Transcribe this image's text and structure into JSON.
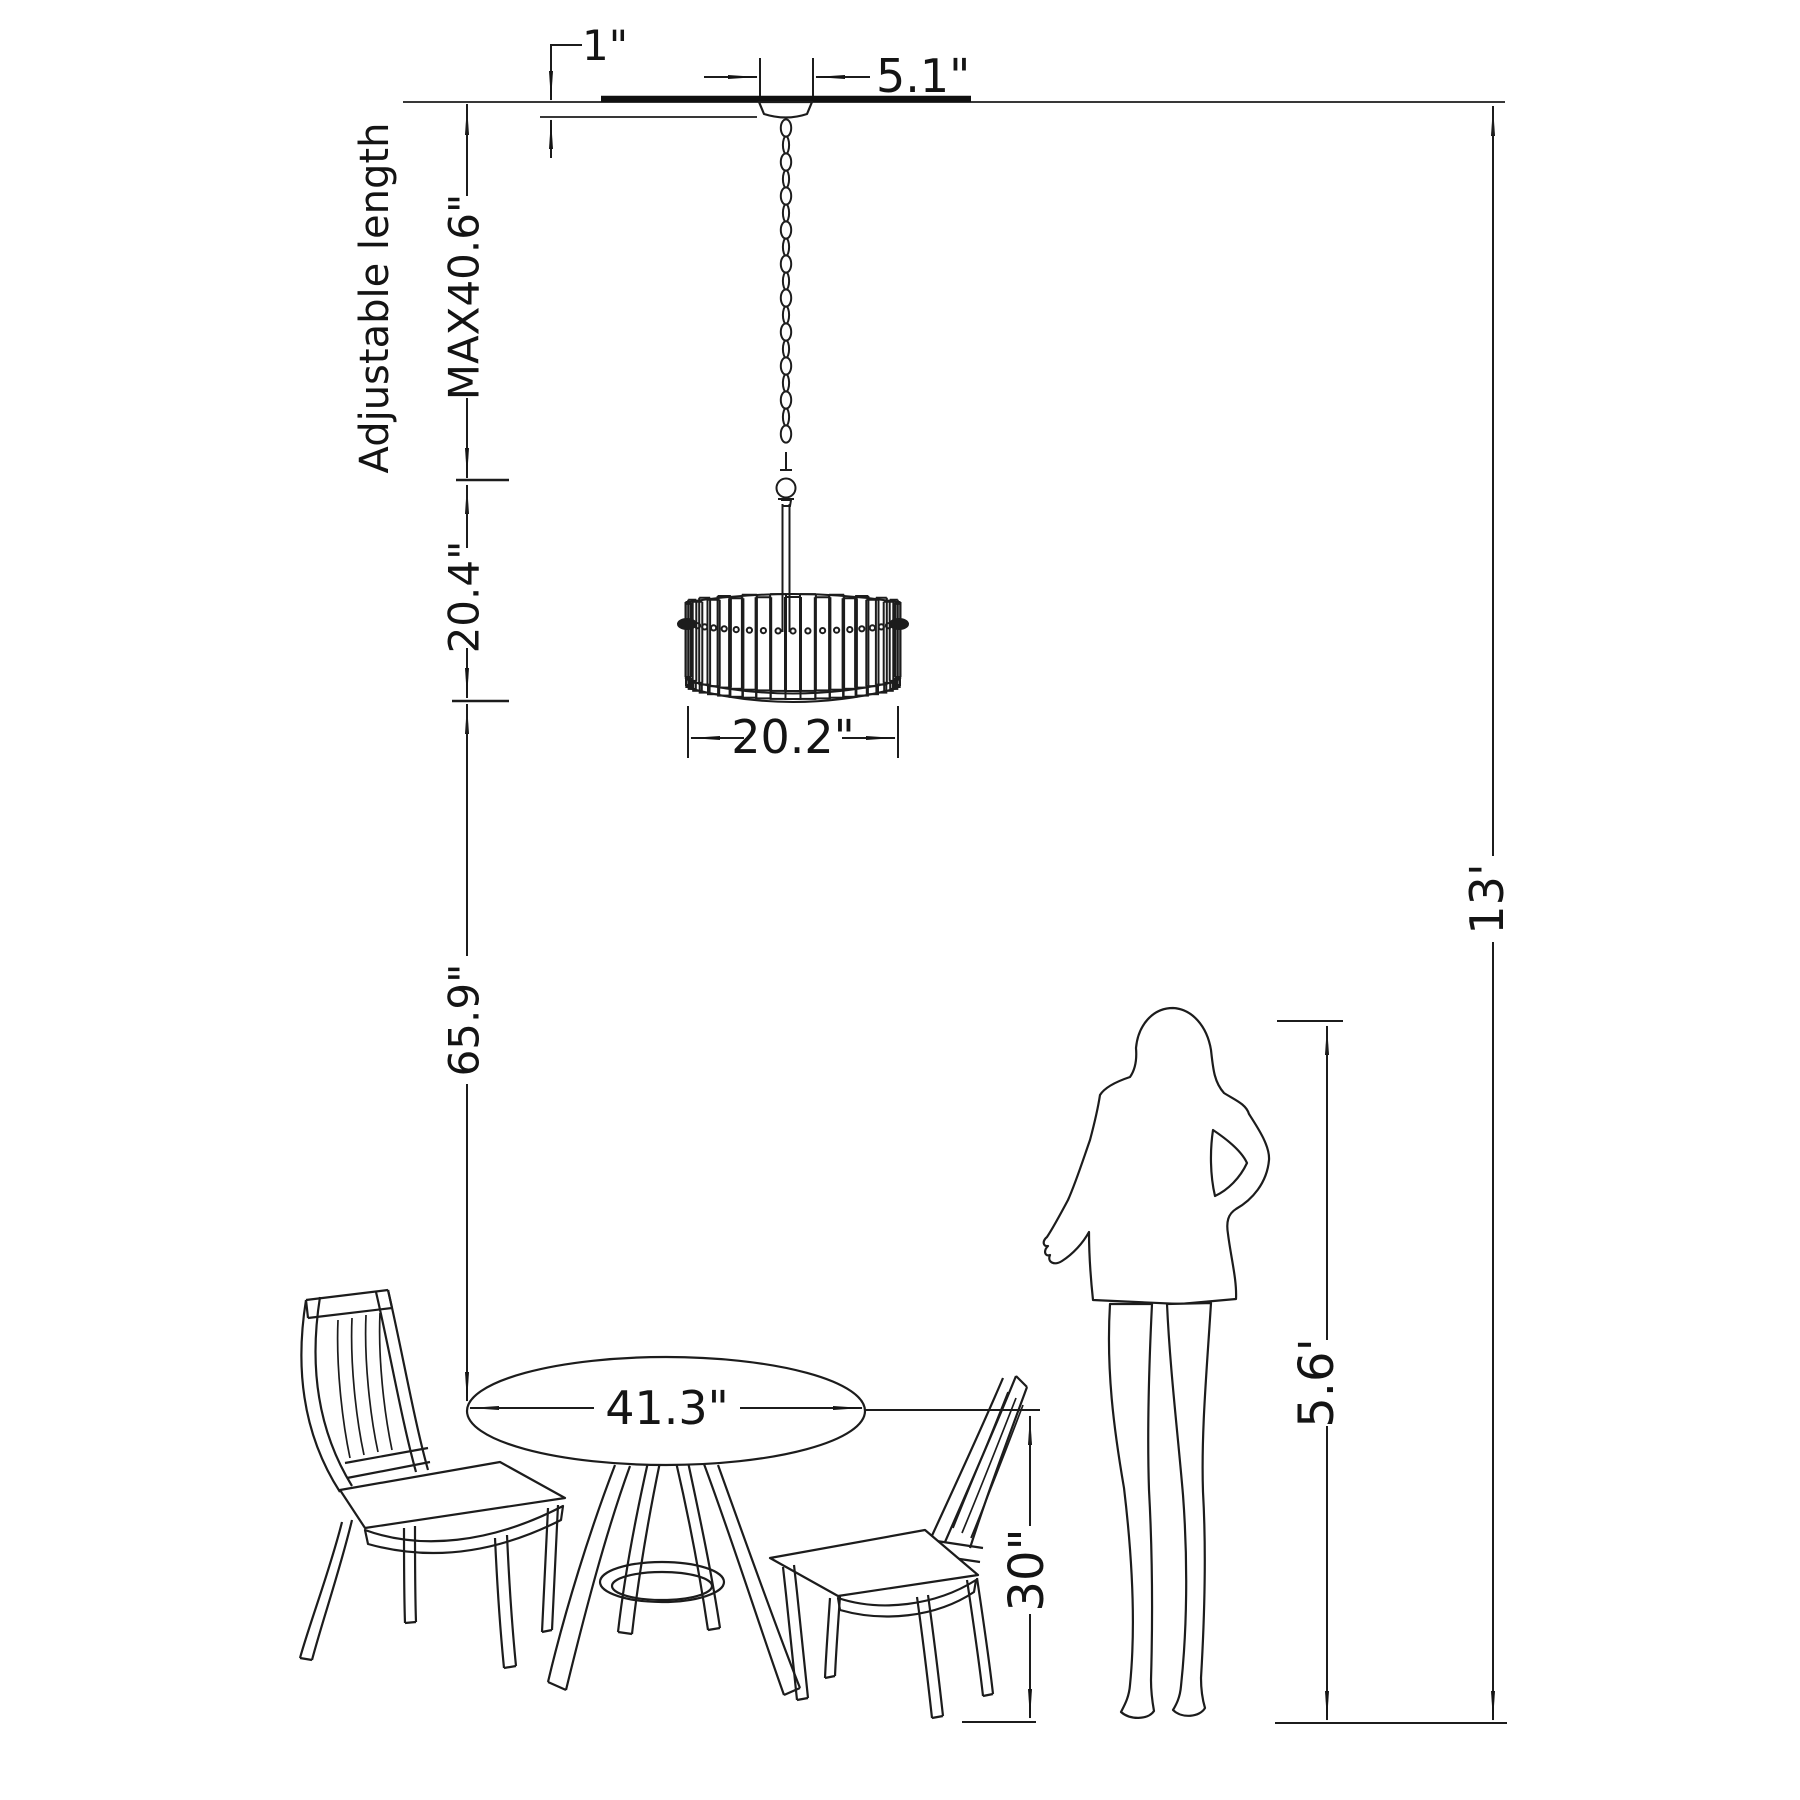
{
  "diagram": {
    "background": "#ffffff",
    "line_color": "#1c1c1c",
    "labels": {
      "canopy_height": "1\"",
      "canopy_width": "5.1\"",
      "adjustable_length": "Adjustable length",
      "max_drop": "MAX40.6\"",
      "fixture_height": "20.4\"",
      "shade_diameter": "20.2\"",
      "shade_to_table": "65.9\"",
      "table_diameter": "41.3\"",
      "table_height": "30\"",
      "person_height": "5.6'",
      "ceiling_height": "13'"
    }
  }
}
